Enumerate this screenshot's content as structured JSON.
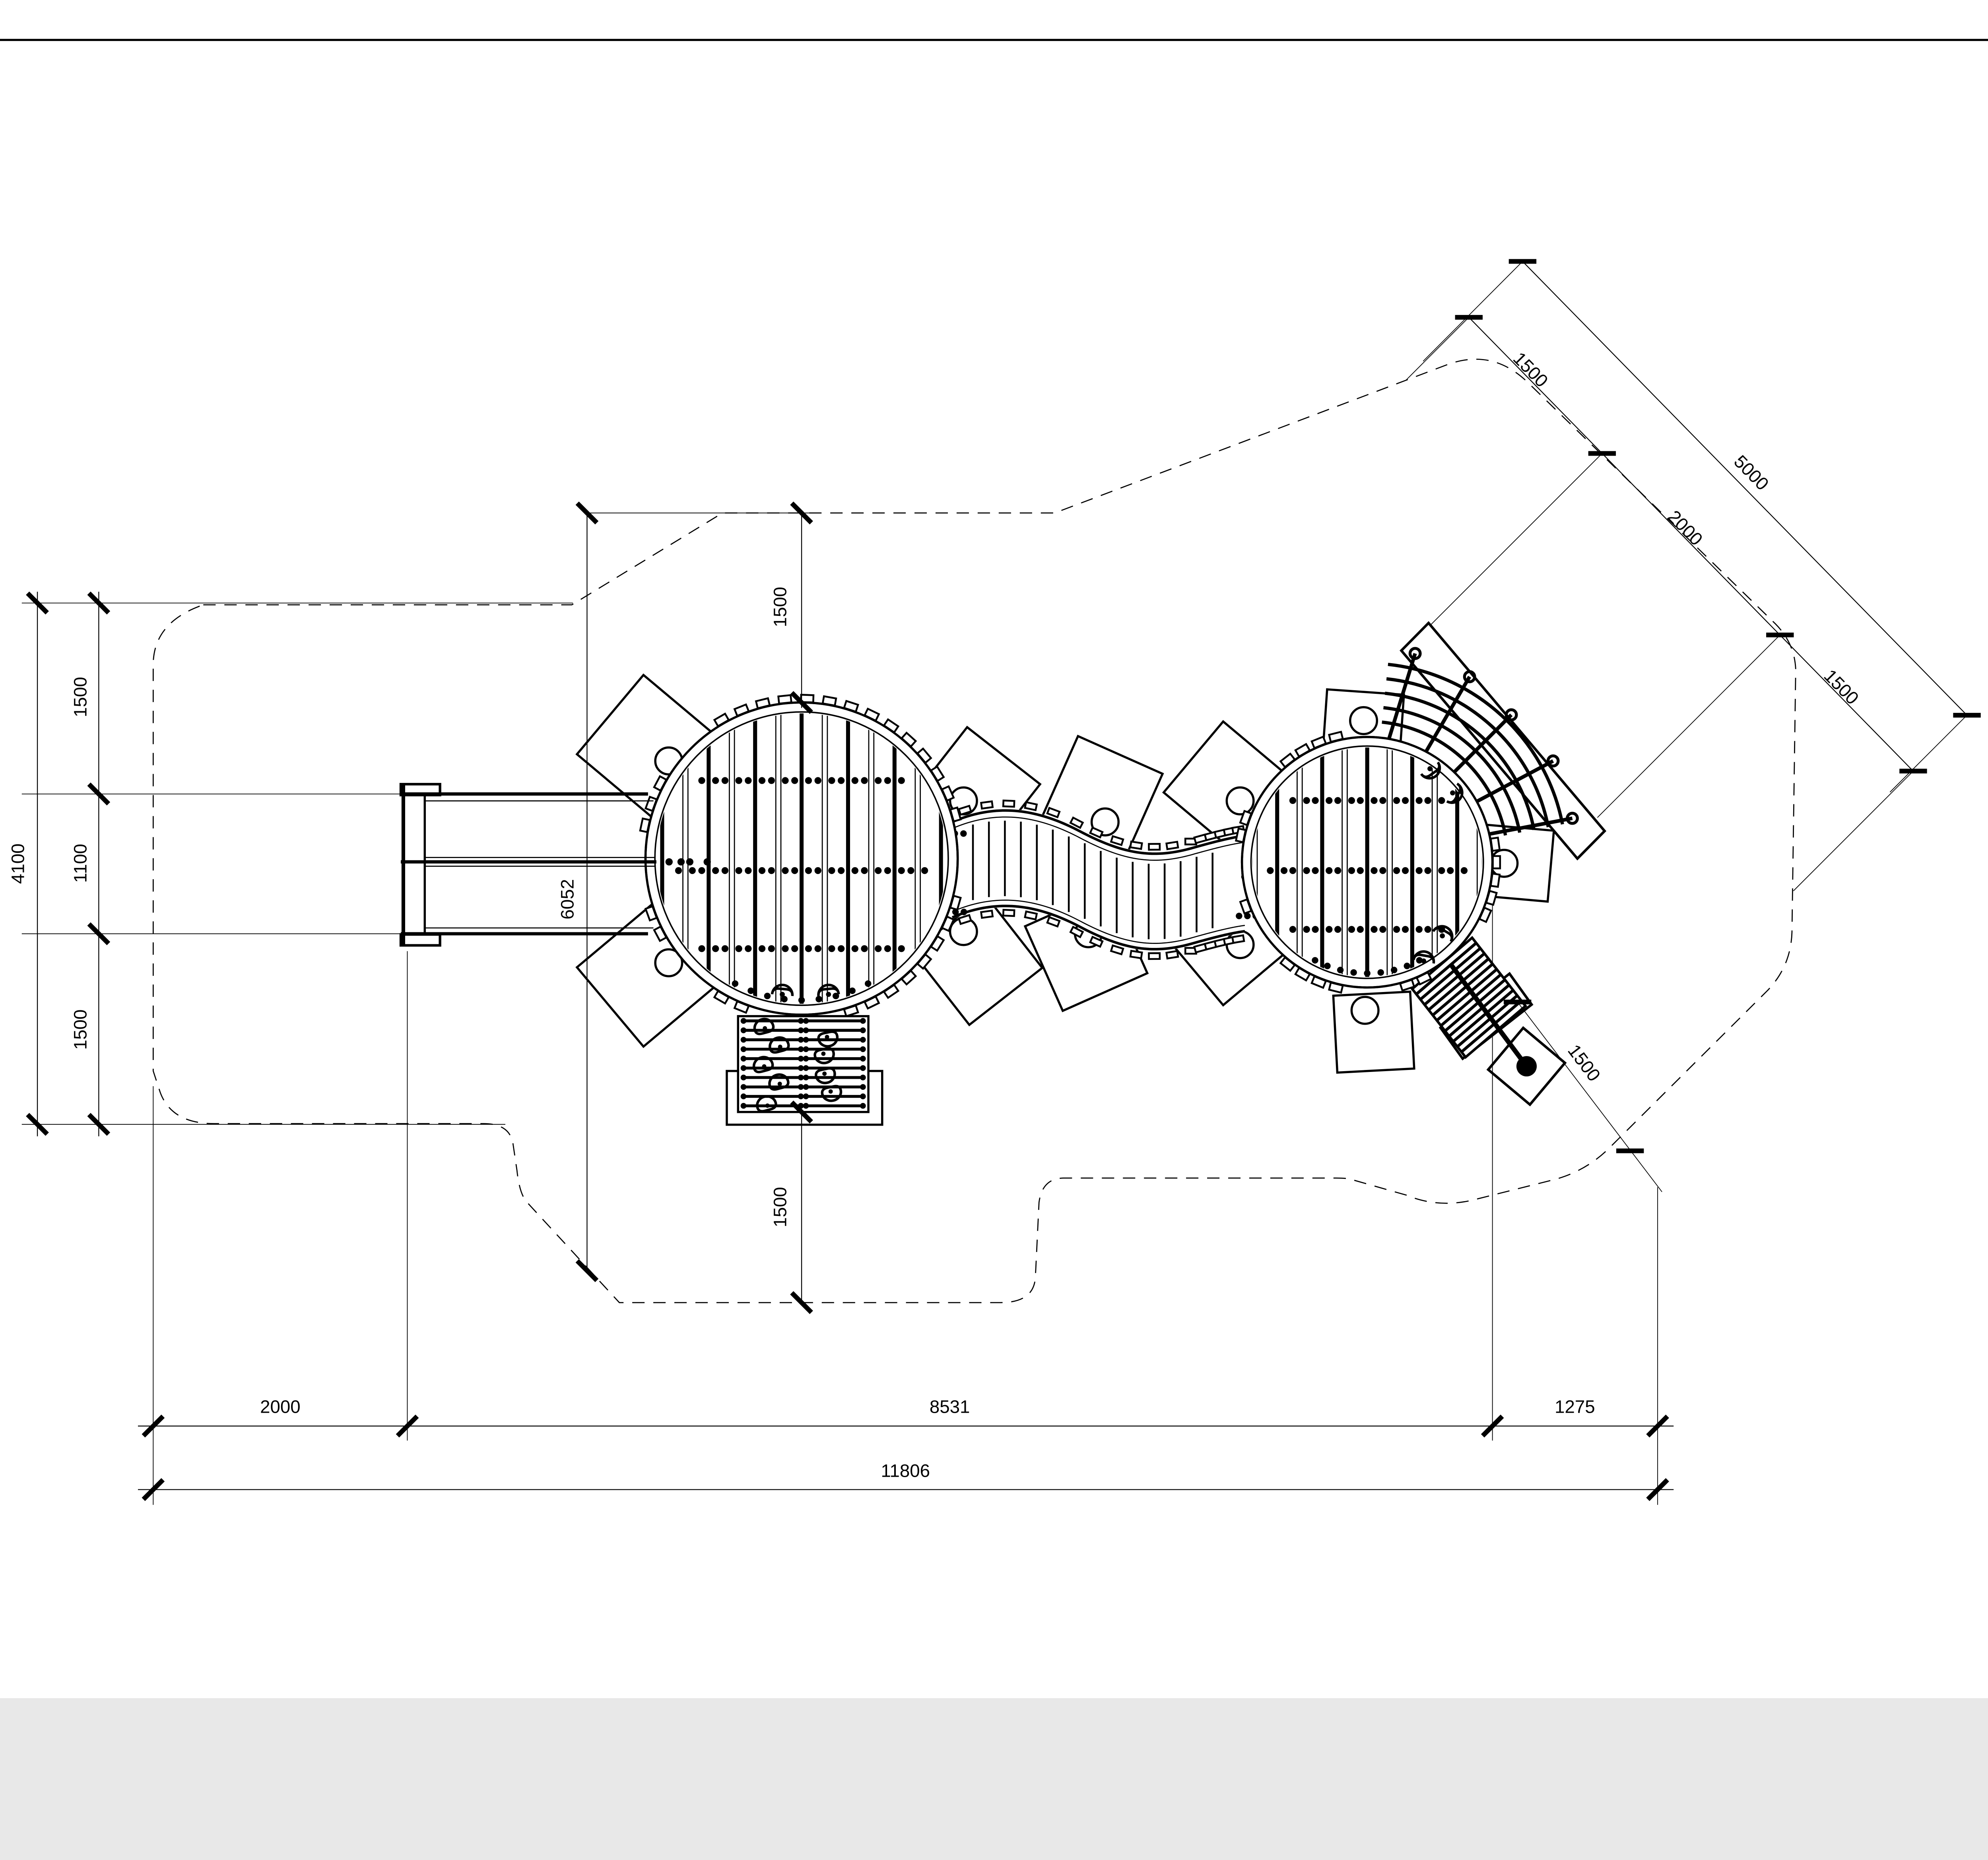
{
  "drawing": {
    "type": "playground-equipment-plan-top-view",
    "units": "mm",
    "background_color": "#ffffff",
    "line_color": "#000000",
    "boundary_style": "dashed-safety-zone"
  },
  "dimensions": {
    "left": {
      "total": "4100",
      "segments": [
        "1500",
        "1100",
        "1500"
      ]
    },
    "top_diagonal": {
      "total": "5000",
      "segments": [
        "1500",
        "2000",
        "1500"
      ]
    },
    "bottom_row1": [
      "2000",
      "8531",
      "1275"
    ],
    "bottom_row2": "11806",
    "vertical_top": "1500",
    "vertical_bottom": "1500",
    "height_overall": "6052",
    "diag_bottom_right": "1500"
  },
  "icons": {
    "foot_step": "footprint-icon",
    "handhold": "handhold-step-icon"
  },
  "parts": {
    "left_platform": "large-round-deck",
    "right_platform": "small-round-deck",
    "bridge": "s-curve-plank-bridge",
    "slide": "double-chute-slide",
    "stairs": "access-stairs",
    "net": "arc-climbing-net",
    "ladder": "incline-ramp-ladder"
  }
}
